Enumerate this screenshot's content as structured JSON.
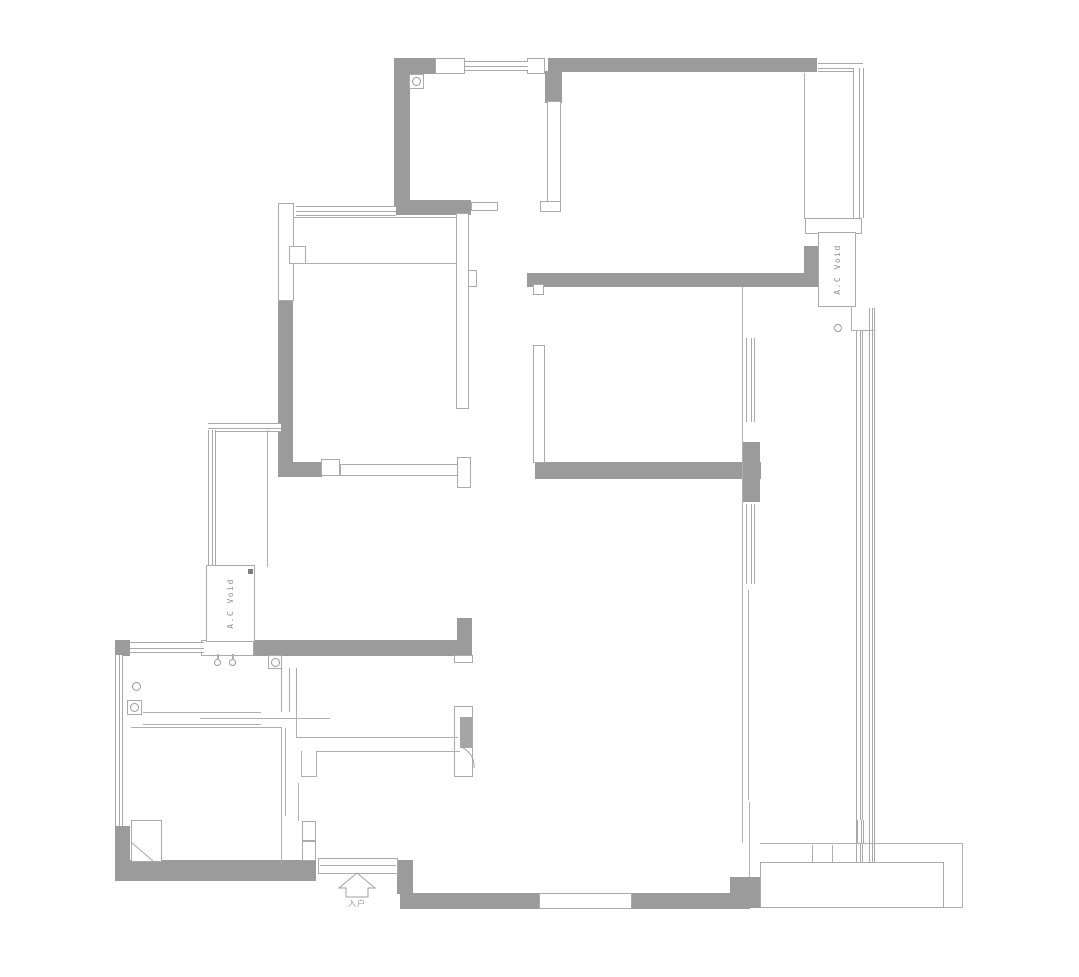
{
  "labels": {
    "ac_void_right": "A.C Void",
    "ac_void_left": "A.C Void",
    "entrance": "入户"
  },
  "colors": {
    "wall_fill": "#9b9b9b",
    "thin_line": "#ababab",
    "label_text": "#8f8f8f",
    "background": "#ffffff"
  },
  "drawing": {
    "type": "architectural floor plan"
  }
}
